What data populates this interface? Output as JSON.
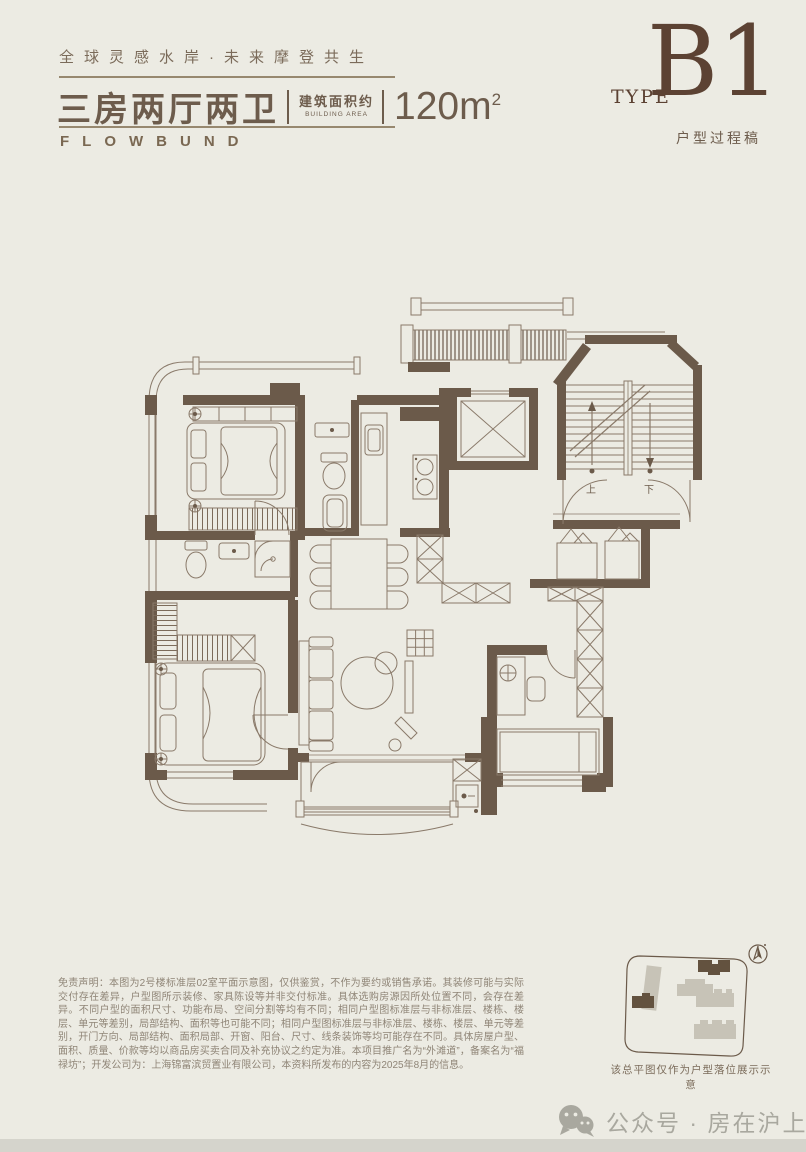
{
  "page": {
    "background": "#ECEBE3",
    "wall_color": "#6B5A4A",
    "line_color": "#8A7A6A",
    "accent_dark": "#5C4233",
    "footer_bar_color": "#D5D4CC"
  },
  "header": {
    "tagline": "全球灵感水岸·未来摩登共生",
    "title": "三房两厅两卫",
    "area_label_cn": "建筑面积约",
    "area_label_en": "BUILDING AREA",
    "area_value": "120m",
    "area_sup": "2",
    "brand": "FLOWBUND",
    "type_label": "TYPE",
    "type_value": "B1",
    "type_note": "户型过程稿"
  },
  "floor_plan": {
    "stair_up": "上",
    "stair_down": "下",
    "icons": [
      "bed-icon",
      "sofa-icon",
      "dining-table-icon",
      "toilet-icon",
      "bathtub-icon",
      "stove-icon",
      "elevator-icon",
      "staircase-icon",
      "wardrobe-hatch",
      "desk-icon"
    ]
  },
  "site_map": {
    "caption": "该总平图仅作为户型落位展示示意",
    "compass": "north-arrow",
    "building_fill": "#C7C3B7",
    "highlight_fill": "#63523F"
  },
  "disclaimer": {
    "text": "免责声明：本图为2号楼标准层02室平面示意图，仅供鉴赏，不作为要约或销售承诺。其装修可能与实际交付存在差异，户型图所示装修、家具陈设等并非交付标准。具体选购房源因所处位置不同，会存在差异。不同户型的面积尺寸、功能布局、空间分割等均有不同；相同户型图标准层与非标准层、楼栋、楼层、单元等差别，局部结构、面积等也可能不同；相同户型图标准层与非标准层、楼栋、楼层、单元等差别，开门方向、局部结构、面积局部、开窗、阳台、尺寸、线条装饰等均可能存在不同。具体房屋户型、面积、质量、价款等均以商品房买卖合同及补充协议之约定为准。本项目推广名为“外滩道”，备案名为“福禄坊”；开发公司为：上海锦富滨贸置业有限公司，本资料所发布的内容为2025年8月的信息。"
  },
  "watermark": {
    "icon": "wechat-icon",
    "text": "公众号 · 房在沪上"
  }
}
